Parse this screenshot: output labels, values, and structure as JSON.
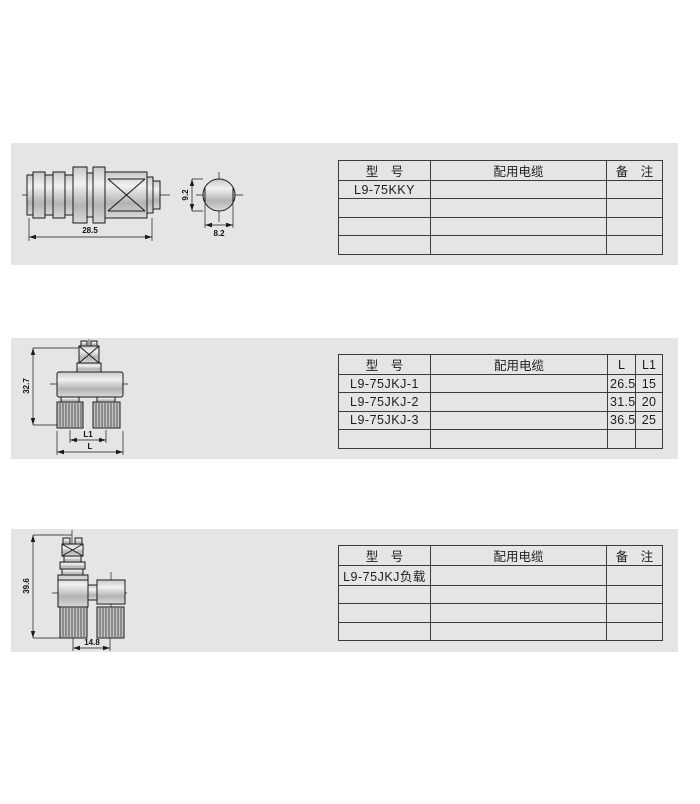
{
  "page": {
    "panel_bg": "#e5e5e5",
    "line_color": "#1a1a1a"
  },
  "sections": [
    {
      "drawing": {
        "dims": {
          "length": "28.5",
          "end_height": "9.2",
          "end_width": "8.2"
        }
      },
      "table": {
        "headers": [
          "型　号",
          "配用电缆",
          "备　注"
        ],
        "rows": [
          [
            "L9-75KKY",
            "",
            ""
          ],
          [
            "",
            "",
            ""
          ],
          [
            "",
            "",
            ""
          ],
          [
            "",
            "",
            ""
          ]
        ]
      }
    },
    {
      "drawing": {
        "dims": {
          "height": "32.7",
          "inner_label": "L1",
          "outer_label": "L"
        }
      },
      "table": {
        "headers": [
          "型　号",
          "配用电缆",
          "L",
          "L1"
        ],
        "rows": [
          [
            "L9-75JKJ-1",
            "",
            "26.5",
            "15"
          ],
          [
            "L9-75JKJ-2",
            "",
            "31.5",
            "20"
          ],
          [
            "L9-75JKJ-3",
            "",
            "36.5",
            "25"
          ],
          [
            "",
            "",
            "",
            ""
          ]
        ]
      }
    },
    {
      "drawing": {
        "dims": {
          "height": "39.6",
          "spacing": "14.8"
        }
      },
      "table": {
        "headers": [
          "型　号",
          "配用电缆",
          "备　注"
        ],
        "rows": [
          [
            "L9-75JKJ负载",
            "",
            ""
          ],
          [
            "",
            "",
            ""
          ],
          [
            "",
            "",
            ""
          ],
          [
            "",
            "",
            ""
          ]
        ]
      }
    }
  ]
}
